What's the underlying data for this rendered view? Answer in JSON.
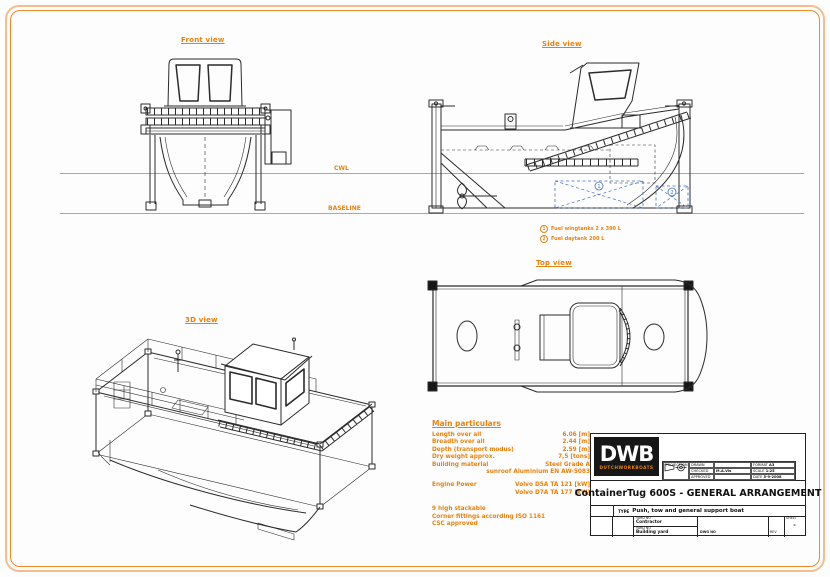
{
  "colors": {
    "accent": "#e8820e",
    "line_dark": "#2b2b2b",
    "blue": "#4472c4",
    "border_outer": "#f6bd8a",
    "border_inner": "#ee8a2a"
  },
  "views": {
    "front": "Front view",
    "side": "Side view",
    "top": "Top view",
    "iso": "3D view"
  },
  "ref_lines": {
    "cwl": "CWL",
    "baseline": "BASELINE"
  },
  "notes": [
    {
      "num": "1",
      "text": "Fuel wingtanks 2 x 390 L"
    },
    {
      "num": "2",
      "text": "Fuel daytank 200 L"
    }
  ],
  "particulars": {
    "title": "Main particulars",
    "rows": [
      {
        "label": "Length over all",
        "value": "6.06 [m]"
      },
      {
        "label": "Breadth over all",
        "value": "2.44 [m]"
      },
      {
        "label": "Depth (transport modus)",
        "value": "2.59 [m]"
      },
      {
        "label": "Dry weight approx.",
        "value": "7,5 [tons]"
      },
      {
        "label": "Building material",
        "value": "Steel Grade A"
      },
      {
        "label": "",
        "value": "sunroof Aluminium EN AW-5083"
      }
    ],
    "engine_label": "Engine Power",
    "engine_lines": [
      "Volvo D5A TA 121 [kW]",
      "Volvo D7A TA 177 [kW]"
    ],
    "footer": [
      "9 high stackable",
      "Corner fittings according ISO 1161",
      "CSC approved"
    ]
  },
  "title_block": {
    "logo_text": "DWB",
    "logo_sub": "DUTCHWORKBOATS",
    "drawn_label": "DRAWN",
    "drawn": "",
    "checked_label": "CHECKED",
    "checked": "M.A.Vis",
    "approved_label": "APPROVED",
    "approved": "",
    "format_label": "FORMAT",
    "format": "A3",
    "scale_label": "SCALE",
    "scale": "1:25",
    "date_label": "DATE",
    "date": "5-9-2008",
    "projection_label": "PROJECTION",
    "title": "ContainerTug 600S - GENERAL ARRANGEMENT",
    "type_label": "TYPE",
    "type_value": "Push, tow and general support boat",
    "yard_label": "YARD NO",
    "yard1": "Contractor",
    "yard2": "Building yard",
    "dwg_label": "DWG NO",
    "rev_label": "REV",
    "sheet_label": "SHEET",
    "sheet_value": "-"
  }
}
